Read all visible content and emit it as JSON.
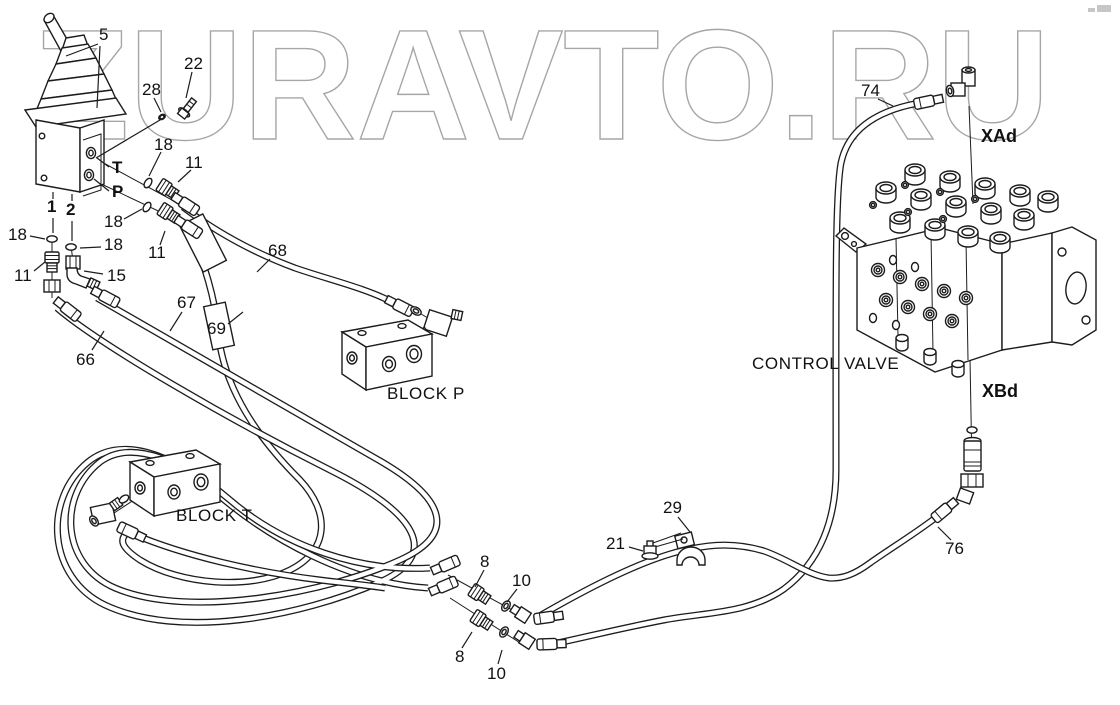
{
  "watermark": {
    "text": "ZURAVTO.RU"
  },
  "colors": {
    "line": "#1c1c1c",
    "background": "#ffffff",
    "watermark_outline": "#a6a6a6",
    "corner_mark": "#c6c6c6"
  },
  "components": {
    "control_valve": "CONTROL VALVE",
    "block_p": "BLOCK P",
    "block_t": "BLOCK  T"
  },
  "ports": {
    "t": "T",
    "p": "P",
    "n1": "1",
    "n2": "2"
  },
  "valve_ports": {
    "xad": "XAd",
    "xbd": "XBd"
  },
  "callouts": {
    "5": "5",
    "8": "8",
    "10": "10",
    "11": "11",
    "15": "15",
    "18": "18",
    "21": "21",
    "22": "22",
    "28": "28",
    "29": "29",
    "66": "66",
    "67": "67",
    "68": "68",
    "69": "69",
    "74": "74",
    "76": "76"
  }
}
